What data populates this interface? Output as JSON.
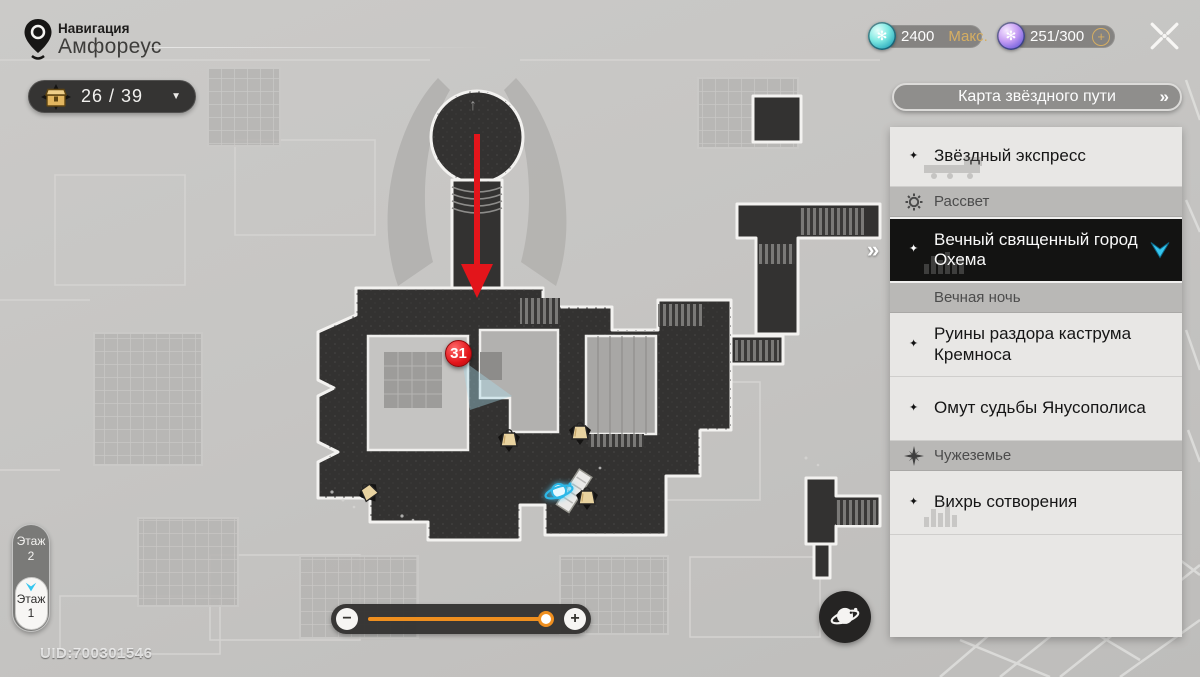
{
  "header": {
    "nav_label": "Навигация",
    "location_name": "Амфореус"
  },
  "collectibles_counter": {
    "count": "26 / 39"
  },
  "currency_bar": {
    "trailblaze_power": {
      "value": "2400",
      "suffix": "Макс."
    },
    "reserve_power": {
      "value": "251/300",
      "suffix": "+"
    }
  },
  "star_rail_map_button": {
    "label": "Карта звёздного пути"
  },
  "sidebar": {
    "items": [
      {
        "label": "Звёздный экспресс",
        "type": "location"
      },
      {
        "label": "Рассвет",
        "type": "world-header"
      },
      {
        "label": "Вечный священный город Охема",
        "type": "location",
        "selected": true
      },
      {
        "label": "Вечная ночь",
        "type": "world-header"
      },
      {
        "label": "Руины раздора каструма Кремноса",
        "type": "location"
      },
      {
        "label": "Омут судьбы Янусополиса",
        "type": "location"
      },
      {
        "label": "Чужеземье",
        "type": "world-header"
      },
      {
        "label": "Вихрь сотворения",
        "type": "location"
      }
    ]
  },
  "map": {
    "marker_number": "31",
    "uid": "UID:700301546"
  },
  "floor_selector": {
    "upper_label": "Этаж",
    "upper_value": "2",
    "lower_label": "Этаж",
    "lower_value": "1"
  },
  "icons": {
    "star_bullet": "✦",
    "dropdown_arrow": "▼",
    "double_chevron": "»",
    "plaza_up_arrow": "↑",
    "minus": "−",
    "plus": "+"
  },
  "colors": {
    "accent_cyan": "#35c6ef",
    "accent_orange": "#ef8f1f",
    "marker_red": "#e3151b",
    "gold": "#d6ae62"
  }
}
